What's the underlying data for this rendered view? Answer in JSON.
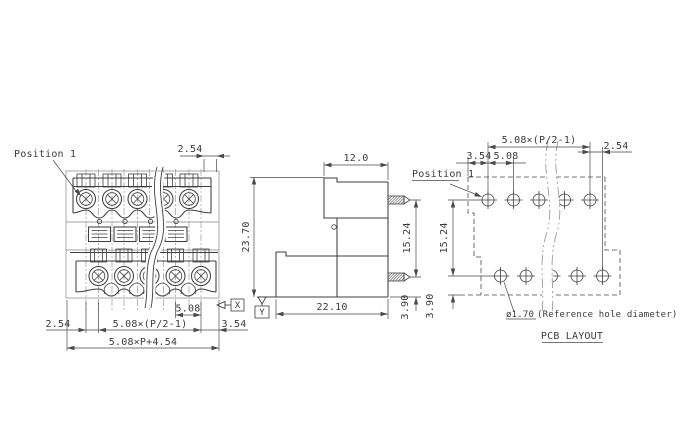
{
  "colors": {
    "background": "#ffffff",
    "line": "#3f3f3f",
    "dim_line": "#4a4a4a",
    "light_line": "#a0a0a0",
    "text": "#3b3b3b"
  },
  "front_view": {
    "position_label": "Position 1",
    "datum_label": "X",
    "dims": {
      "top_pitch_offset": "2.54",
      "pin_pitch": "5.08",
      "pitch_group": "5.08×(P/2-1)",
      "left_offset": "2.54",
      "right_offset": "3.54",
      "overall_width": "5.08×P+4.54"
    }
  },
  "side_view": {
    "datum_label": "Y",
    "dims": {
      "top_width": "12.0",
      "overall_height": "23.70",
      "pin_row_spacing": "15.24",
      "pin_to_bottom": "3.90",
      "overall_depth": "22.10"
    }
  },
  "pcb_layout": {
    "title": "PCB LAYOUT",
    "position_label": "Position 1",
    "hole_diameter": "ø1.70",
    "hole_note": "(Reference hole diameter)",
    "dims": {
      "pitch_group": "5.08×(P/2-1)",
      "row_end_offset": "2.54",
      "edge_offset": "3.54",
      "pin_pitch": "5.08",
      "row_spacing": "15.24",
      "row_to_edge": "3.90"
    }
  }
}
